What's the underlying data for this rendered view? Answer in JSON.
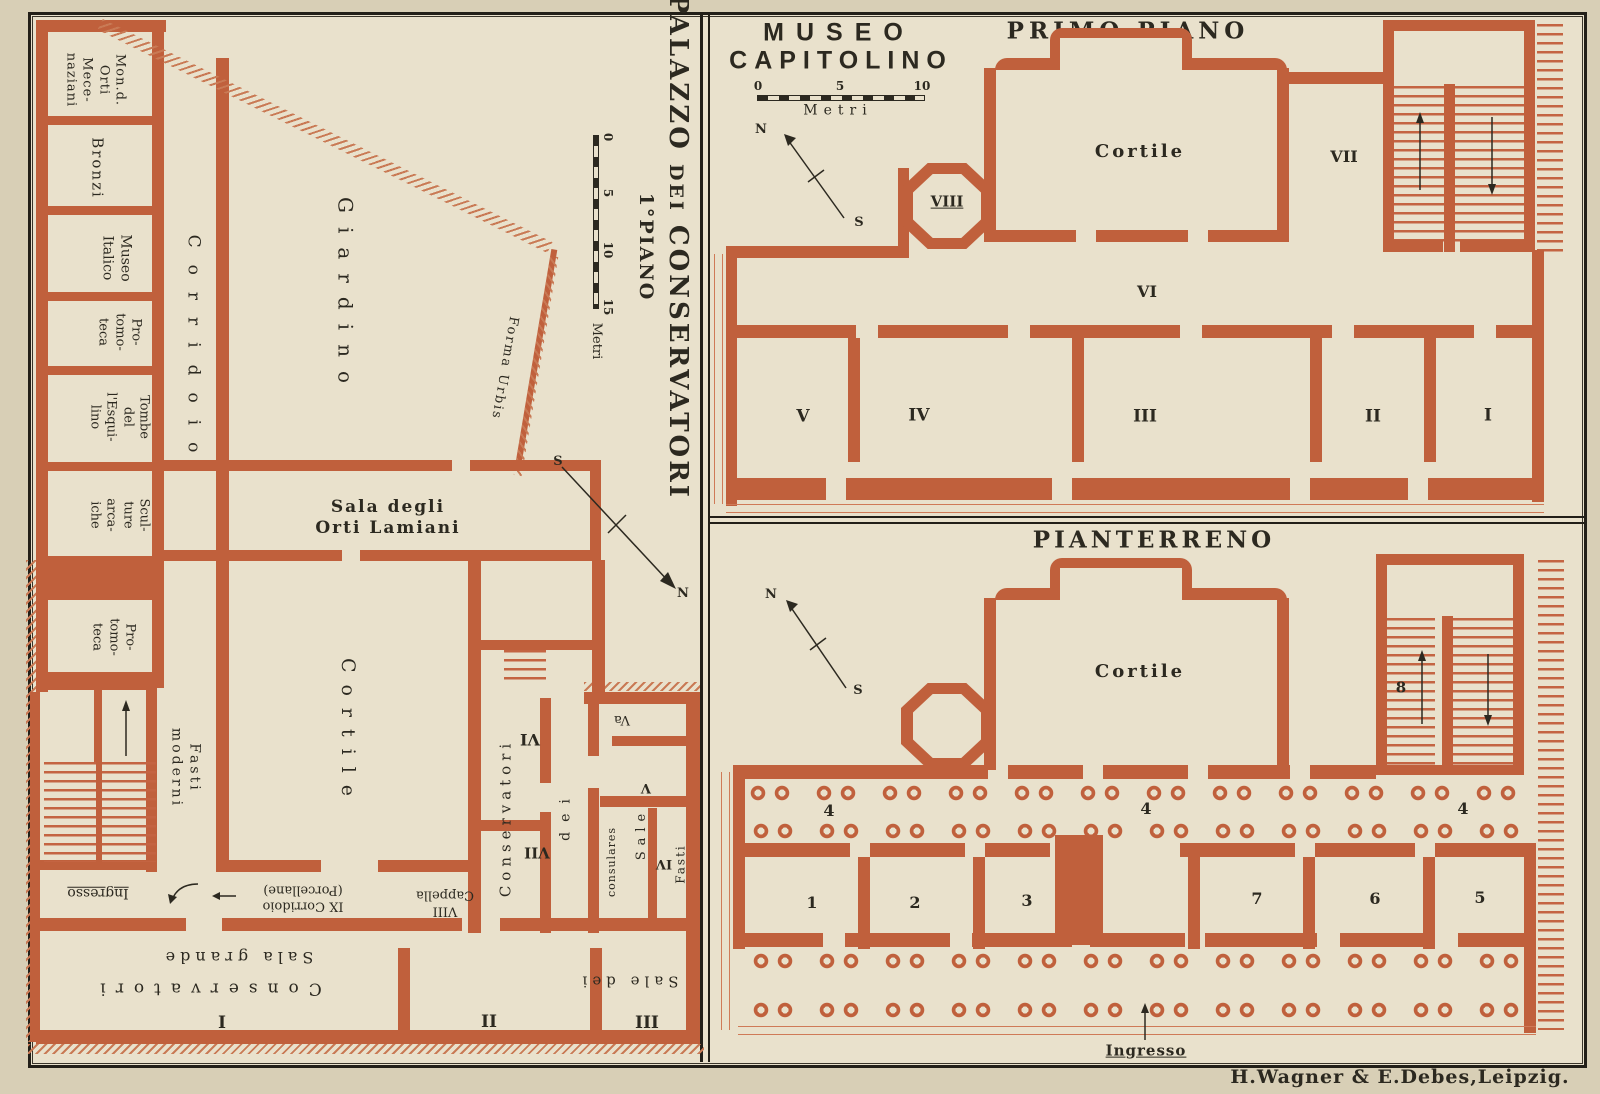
{
  "publisher": "H.Wagner & E.Debes,Leipzig.",
  "left": {
    "title_palazzo": "PALAZZO",
    "title_dei": "DEI",
    "title_conservatori": "CONSERVATORI",
    "title_floor": "1°PIANO",
    "scale": {
      "n0": "0",
      "n5": "5",
      "n10": "10",
      "n15": "15",
      "unit": "Metri"
    },
    "compass": {
      "n": "N",
      "s": "S"
    },
    "rooms": {
      "mon_orti": "Mon.d.\nOrti\nMece-\nnaziani",
      "bronzi": "Bronzi",
      "museo_italico": "Museo\nItalico",
      "protomoteca_upper": "Pro-\ntomo-\nteca",
      "tombe": "Tombe\ndel\nl'Esqui-\nlino",
      "sculture": "Scul-\nture\narca-\niche",
      "protomoteca_lower": "Pro-\ntomo-\nteca",
      "corridoio": "Corridoio",
      "giardino": "Giardino",
      "sala_orti": "Sala degli\nOrti Lamiani",
      "cortile": "Cortile",
      "forma_urbis": "Forma Urbis",
      "fasti_moderni": "Fasti\nmoderni",
      "ingresso": "Ingresso",
      "corridoio_ix": "IX Corridoio\n(Porcellane)",
      "cappella": "VIII\nCappella",
      "sala_grande_num": "I",
      "sala_grande_cons": "Conservatori",
      "sala_grande_name": "Sala grande",
      "room_ii": "II",
      "room_iii": "III",
      "sale_dei": "Sale dei",
      "wing_vi": "VI",
      "wing_vii": "VII",
      "wing_conservatori": "Conservatori",
      "wing_dei": "dei",
      "room_va": "Va",
      "room_v": "V",
      "room_iv": "IV",
      "sale": "Sale",
      "consulares": "consulares",
      "fasti": "Fasti"
    }
  },
  "museo": {
    "title1": "MUSEO",
    "title2": "CAPITOLINO",
    "scale": {
      "n0": "0",
      "n5": "5",
      "n10": "10",
      "unit": "Metri"
    },
    "primo": {
      "heading": "PRIMO PIANO",
      "cortile": "Cortile",
      "viii": "VIII",
      "vii": "VII",
      "vi": "VI",
      "v": "V",
      "iv": "IV",
      "iii": "III",
      "ii": "II",
      "i": "I",
      "compass": {
        "n": "N",
        "s": "S"
      }
    },
    "pianterreno": {
      "heading": "PIANTERRENO",
      "cortile": "Cortile",
      "n8": "8",
      "four_a": "4",
      "four_b": "4",
      "four_c": "4",
      "n1": "1",
      "n2": "2",
      "n3": "3",
      "n7": "7",
      "n6": "6",
      "n5": "5",
      "ingresso": "Ingresso",
      "compass": {
        "n": "N",
        "s": "S"
      }
    }
  }
}
